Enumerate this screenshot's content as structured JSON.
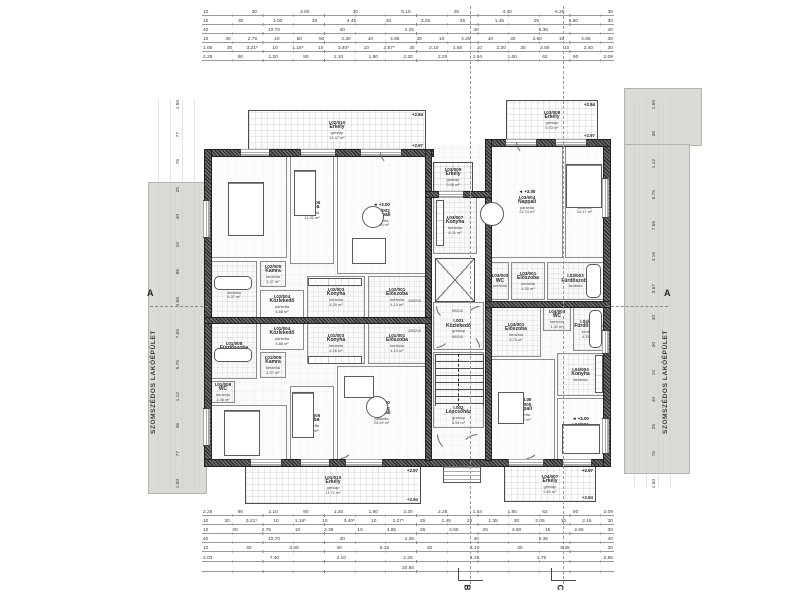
{
  "labels": {
    "neighbor": "SZOMSZÉDOS LAKÓÉPÜLET",
    "section_a": "A",
    "grid_b": "B",
    "grid_c": "C",
    "overall_width": "20.80",
    "overall_half": "10.70"
  },
  "door_tags": {
    "a": "100/210",
    "b": "90/210"
  },
  "rooms": [
    {
      "id": "I.02/010",
      "name": "Erkély",
      "mat": "greslap",
      "area": "11.47 m²",
      "elev": "+2.94",
      "elev2": "+2.97",
      "floor": "bal",
      "x": 248,
      "y": 110,
      "w": 178,
      "h": 40
    },
    {
      "id": "I.02/007",
      "name": "Szoba",
      "mat": "parketta",
      "area": "13.76 m²",
      "elev": "+3.00",
      "floor": "parquet",
      "x": 211,
      "y": 156,
      "w": 76,
      "h": 102
    },
    {
      "id": "I.02/006",
      "name": "Szoba",
      "mat": "parketta",
      "area": "11.92 m²",
      "floor": "parquet",
      "x": 290,
      "y": 156,
      "w": 44,
      "h": 108
    },
    {
      "id": "I.02/002",
      "name": "Nappali",
      "mat": "parketta",
      "area": "24.26 m²",
      "elev": "+3.00",
      "floor": "parquet",
      "x": 337,
      "y": 156,
      "w": 89,
      "h": 118
    },
    {
      "id": "I.02/008",
      "name": "Fürdőszoba",
      "mat": "kerámia",
      "area": "5.37 m²",
      "floor": "tile",
      "x": 211,
      "y": 261,
      "w": 46,
      "h": 57
    },
    {
      "id": "I.02/005",
      "name": "Kamra",
      "mat": "kerámia",
      "area": "1.07 m²",
      "floor": "tile",
      "x": 260,
      "y": 261,
      "w": 26,
      "h": 26
    },
    {
      "id": "I.02/004",
      "name": "Közlekedő",
      "mat": "parketta",
      "area": "5.88 m²",
      "floor": "parquet",
      "x": 260,
      "y": 290,
      "w": 44,
      "h": 28
    },
    {
      "id": "I.02/003",
      "name": "Konyha",
      "mat": "kerámia",
      "area": "8.29 m²",
      "floor": "tile",
      "x": 307,
      "y": 276,
      "w": 58,
      "h": 42
    },
    {
      "id": "I.02/001",
      "name": "Előszoba",
      "mat": "kerámia",
      "area": "4.13 m²",
      "floor": "tile",
      "x": 368,
      "y": 276,
      "w": 58,
      "h": 42
    },
    {
      "id": "I.01/001",
      "name": "Előszoba",
      "mat": "kerámia",
      "area": "4.13 m²",
      "floor": "tile",
      "x": 368,
      "y": 322,
      "w": 58,
      "h": 42
    },
    {
      "id": "I.01/003",
      "name": "Konyha",
      "mat": "kerámia",
      "area": "8.26 m²",
      "floor": "tile",
      "x": 307,
      "y": 322,
      "w": 58,
      "h": 42
    },
    {
      "id": "I.01/004",
      "name": "Közlekedő",
      "mat": "parketta",
      "area": "5.88 m²",
      "floor": "parquet",
      "x": 260,
      "y": 322,
      "w": 44,
      "h": 28
    },
    {
      "id": "I.01/005",
      "name": "Kamra",
      "mat": "kerámia",
      "area": "1.07 m²",
      "floor": "tile",
      "x": 260,
      "y": 352,
      "w": 26,
      "h": 26
    },
    {
      "id": "I.01/008",
      "name": "Fürdőszoba",
      "mat": "kerámia",
      "area": "5.25 m²",
      "floor": "tile",
      "x": 211,
      "y": 322,
      "w": 46,
      "h": 57
    },
    {
      "id": "I.01/009",
      "name": "WC",
      "mat": "kerámia",
      "area": "1.06 m²",
      "floor": "tile",
      "x": 211,
      "y": 381,
      "w": 24,
      "h": 22
    },
    {
      "id": "I.01/007",
      "name": "Szoba",
      "mat": "parketta",
      "area": "10.71 m²",
      "elev": "+3.00",
      "floor": "parquet",
      "x": 211,
      "y": 405,
      "w": 76,
      "h": 55
    },
    {
      "id": "I.01/006",
      "name": "Szoba",
      "mat": "parketta",
      "area": "9.57 m²",
      "floor": "parquet",
      "x": 290,
      "y": 386,
      "w": 44,
      "h": 74
    },
    {
      "id": "I.01/002",
      "name": "Nappali",
      "mat": "parketta",
      "area": "24.09 m²",
      "elev": "+3.00",
      "floor": "parquet",
      "x": 337,
      "y": 366,
      "w": 89,
      "h": 94
    },
    {
      "id": "I.01/010",
      "name": "Erkély",
      "mat": "greslap",
      "area": "11.71 m²",
      "elev": "+2.97",
      "elev2": "+2.94",
      "floor": "bal",
      "x": 245,
      "y": 466,
      "w": 176,
      "h": 38
    },
    {
      "id": "I.03/009",
      "name": "Erkély",
      "mat": "greslap",
      "area": "3.08 m²",
      "floor": "bal",
      "x": 433,
      "y": 162,
      "w": 40,
      "h": 30
    },
    {
      "id": "I.03/007",
      "name": "Konyha",
      "mat": "kerámia",
      "area": "8.21 m²",
      "floor": "tile",
      "x": 433,
      "y": 196,
      "w": 44,
      "h": 58
    },
    {
      "id": "I.03/008",
      "name": "Erkély",
      "mat": "greslap",
      "area": "5.03 m²",
      "elev": "+2.94",
      "elev2": "+2.97",
      "floor": "bal",
      "x": 506,
      "y": 100,
      "w": 92,
      "h": 40
    },
    {
      "id": "I.03/004",
      "name": "Nappali",
      "mat": "parketta",
      "area": "22.74 m²",
      "elev": "+3.00",
      "floor": "parquet",
      "x": 491,
      "y": 146,
      "w": 72,
      "h": 112
    },
    {
      "id": "I.03/005",
      "name": "Szoba",
      "mat": "parketta",
      "area": "14.17 m²",
      "elev": "+3.00",
      "floor": "parquet",
      "x": 565,
      "y": 146,
      "w": 39,
      "h": 112
    },
    {
      "id": "I.03/003",
      "name": "WC",
      "mat": "kerámia",
      "floor": "tile",
      "x": 491,
      "y": 262,
      "w": 18,
      "h": 38
    },
    {
      "id": "I.03/001",
      "name": "Előszoba",
      "mat": "kerámia",
      "area": "5.35 m²",
      "floor": "tile",
      "x": 511,
      "y": 262,
      "w": 34,
      "h": 38
    },
    {
      "id": "I.03/002",
      "name": "Fürdőszoba",
      "mat": "kerámia",
      "floor": "tile",
      "x": 547,
      "y": 262,
      "w": 57,
      "h": 38
    },
    {
      "id": "I.04/001",
      "name": "Előszoba",
      "mat": "kerámia",
      "area": "5.70 m²",
      "floor": "tile",
      "x": 491,
      "y": 307,
      "w": 50,
      "h": 50
    },
    {
      "id": "I.04/003",
      "name": "WC",
      "mat": "kerámia",
      "area": "1.40 m²",
      "floor": "tile",
      "x": 543,
      "y": 307,
      "w": 28,
      "h": 24
    },
    {
      "id": "I.04/002",
      "name": "Fürdőszoba",
      "mat": "kerámia",
      "area": "4.33 m²",
      "floor": "tile",
      "x": 573,
      "y": 307,
      "w": 31,
      "h": 44
    },
    {
      "id": "I.04/004",
      "name": "Konyha",
      "mat": "kerámia",
      "floor": "tile",
      "x": 557,
      "y": 353,
      "w": 47,
      "h": 43
    },
    {
      "id": "I.04/005",
      "name": "Nappali",
      "mat": "parketta",
      "area": "17.82 m²",
      "elev": "+3.00",
      "floor": "parquet",
      "x": 491,
      "y": 359,
      "w": 64,
      "h": 101
    },
    {
      "id": "I.04/006",
      "name": "Szoba",
      "mat": "parketta",
      "area": "9.94 m²",
      "elev": "+3.00",
      "floor": "parquet",
      "x": 557,
      "y": 398,
      "w": 47,
      "h": 62
    },
    {
      "id": "I.04/007",
      "name": "Erkély",
      "mat": "greslap",
      "area": "5.60 m²",
      "elev": "+2.97",
      "elev2": "+2.94",
      "floor": "bal",
      "x": 504,
      "y": 466,
      "w": 92,
      "h": 36
    },
    {
      "id": "I.001",
      "name": "Közlekedő",
      "mat": "greslap",
      "floor": "core",
      "x": 433,
      "y": 302,
      "w": 51,
      "h": 48
    },
    {
      "id": "I.002",
      "name": "Lépcsőház",
      "mat": "greslap",
      "area": "6.94 m²",
      "floor": "core",
      "cls": "stairsroom",
      "x": 433,
      "y": 352,
      "w": 51,
      "h": 76
    }
  ],
  "dims": {
    "top": [
      [
        "10",
        "30",
        "3.60",
        "30",
        "5.15",
        "30",
        "4.40",
        "6.35",
        "30"
      ],
      [
        "10",
        "30",
        "3.00",
        "30",
        "4.45",
        "30",
        "3.25",
        "25",
        "1.45",
        "25",
        "6.60",
        "30"
      ],
      [
        "40",
        "10.70",
        "40",
        "2.25",
        "40",
        "6.35",
        "40"
      ],
      [
        "10",
        "30",
        "2.75",
        "10",
        "50",
        "50",
        "2.30",
        "10",
        "4.85",
        "30",
        "10",
        "2.25",
        "10",
        "30",
        "3.60",
        "15",
        "2.65",
        "30"
      ],
      [
        "1.00",
        "30",
        "3.21⁵",
        "10",
        "1.16⁵",
        "10",
        "3.40⁵",
        "10",
        "2.67⁵",
        "30",
        "2.10",
        "1.60",
        "10",
        "2.20",
        "30",
        "2.00",
        "10",
        "2.40",
        "30"
      ],
      [
        "2.25",
        "90",
        "1.20",
        "90",
        "2.10",
        "1.80",
        "2.30",
        "2.25",
        "1.54",
        "1.60",
        "62",
        "90",
        "2.09"
      ]
    ],
    "bottom": [
      [
        "2.25",
        "90",
        "2.10",
        "90",
        "1.20",
        "1.80",
        "2.30",
        "2.25",
        "1.54",
        "1.80",
        "62",
        "90",
        "2.09"
      ],
      [
        "10",
        "30",
        "3.21⁵",
        "10",
        "1.16⁵",
        "10",
        "3.40⁵",
        "10",
        "2.27⁵",
        "25",
        "1.45",
        "25",
        "1.35",
        "30",
        "2.05",
        "10",
        "2.15",
        "30"
      ],
      [
        "10",
        "30",
        "2.75",
        "10",
        "2.36",
        "10",
        "4.85",
        "25",
        "2.65",
        "25",
        "3.60",
        "15",
        "2.65",
        "30"
      ],
      [
        "40",
        "10.70",
        "40",
        "2.25",
        "40",
        "6.35",
        "40"
      ],
      [
        "10",
        "30",
        "3.60",
        "30",
        "5.15",
        "30",
        "4.10",
        "30",
        "6.35",
        "30"
      ],
      [
        "2.03",
        "7.40",
        "2.10",
        "2.25",
        "1.45",
        "3.75",
        "2.85"
      ],
      [
        "20.80"
      ]
    ],
    "left": [
      "1.50",
      "77",
      "76",
      "25",
      "40",
      "10",
      "85",
      "4.66",
      "7.65",
      "5.75",
      "1.12",
      "36",
      "77",
      "1.50"
    ],
    "right": [
      "1.50",
      "36",
      "1.12",
      "5.75",
      "7.65",
      "4.16",
      "3.67",
      "40",
      "30",
      "10",
      "40",
      "25",
      "76",
      "1.50"
    ]
  },
  "colors": {
    "wall": "#2e2e2e",
    "neighbor_fill": "#dbdbd6",
    "line": "#9a9a9a"
  }
}
